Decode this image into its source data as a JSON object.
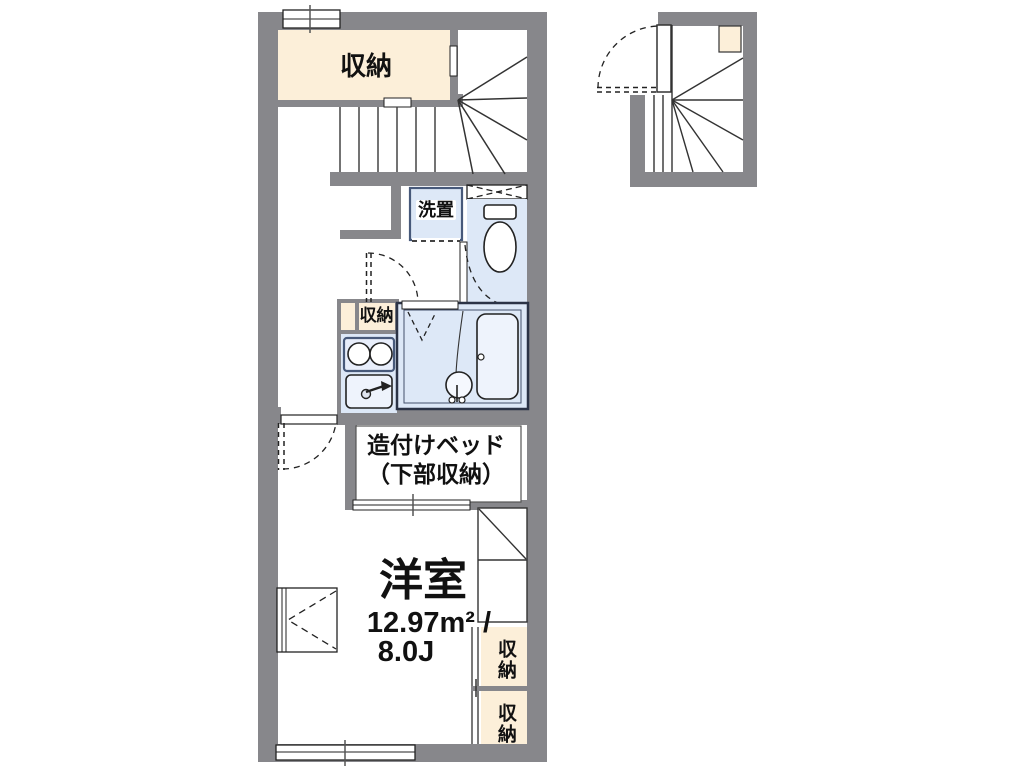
{
  "plan": {
    "storage_top_label": "収納",
    "washer_label": "洗置",
    "storage_small_label": "収納",
    "bed_label_line1": "造付けベッド",
    "bed_label_line2": "（下部収納）",
    "room_name": "洋室",
    "room_area_m2": "12.97m² /",
    "room_area_jo": "8.0J",
    "storage_right_upper_label": "収納",
    "storage_right_lower_label": "収納"
  },
  "colors": {
    "wall": "#87878b",
    "storage_fill": "#fcefd9",
    "wet_area_fill": "#dde8f7",
    "wet_area_border": "#47597a",
    "line": "#333333"
  }
}
